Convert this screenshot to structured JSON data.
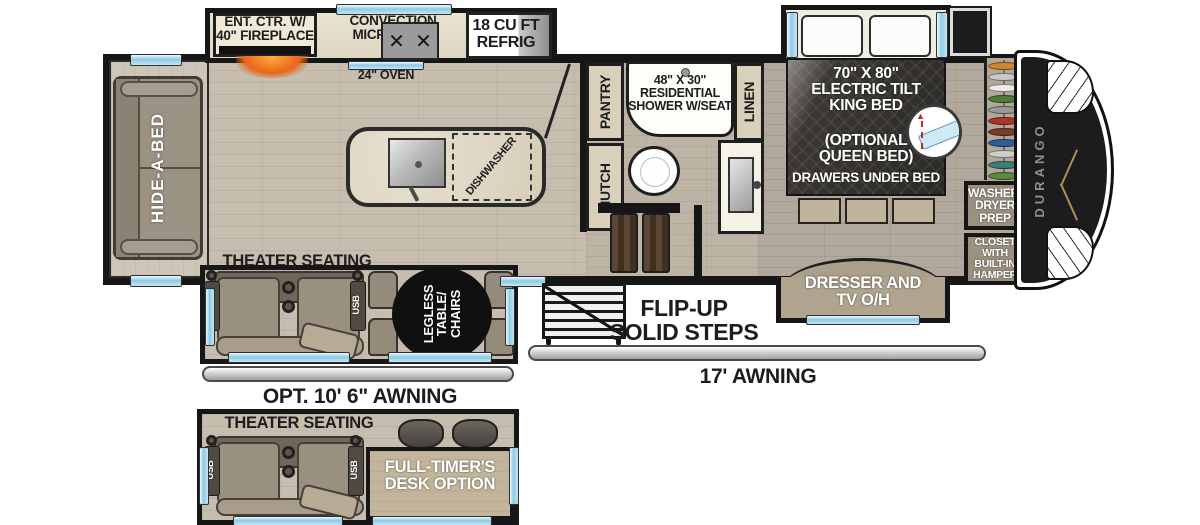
{
  "plan": {
    "brand": "DURANGO",
    "kitchen": {
      "fireplace": "ENT. CTR. W/\n40\" FIREPLACE",
      "microwave": "CONVECTION\nMICROWAVE",
      "refrig": "18 CU FT\nREFRIG",
      "oven": "24\" OVEN",
      "dishwasher": "DISHWASHER"
    },
    "living": {
      "sofa": "HIDE-A-BED",
      "theater": "THEATER SEATING",
      "usb_left": "USB",
      "usb_right": "USB",
      "dinette": "LEGLESS\nTABLE/\nCHAIRS"
    },
    "bath": {
      "pantry": "PANTRY",
      "shower": "48\" X 30\"\nRESIDENTIAL\nSHOWER W/SEAT",
      "linen": "LINEN",
      "hutch": "HUTCH"
    },
    "bedroom": {
      "bed": "70\" X 80\"\nELECTRIC TILT\nKING BED",
      "bed_option": "(OPTIONAL\nQUEEN BED)",
      "bed_drawers": "DRAWERS UNDER BED",
      "washer": "WASHER/\nDRYER\nPREP",
      "closet": "CLOSET\nWITH\nBUILT-IN\nHAMPER",
      "dresser": "DRESSER AND\nTV O/H"
    },
    "exterior": {
      "steps": "FLIP-UP\nSOLID STEPS",
      "awning_main": "17' AWNING",
      "awning_opt": "OPT. 10' 6\" AWNING"
    },
    "option_box": {
      "theater": "THEATER SEATING",
      "usb_left": "USB",
      "usb_right": "USB",
      "desk": "FULL-TIMER'S\nDESK OPTION"
    },
    "wardrobe_clothes_colors": [
      "#d0862f",
      "#c8c8c8",
      "#ececec",
      "#4e7a3a",
      "#9a9a9a",
      "#b13328",
      "#7a3b2e",
      "#2c5f9e",
      "#cfcfcf",
      "#3f7d7d",
      "#5c8a46"
    ],
    "colors": {
      "wall": "#161616",
      "window_glass": "#a9d9ee",
      "fireplace_glow": "#e96a1f",
      "brand_text": "#8f8f8f",
      "accent_gold": "#ad9255",
      "dinette_table": "#101010"
    }
  }
}
